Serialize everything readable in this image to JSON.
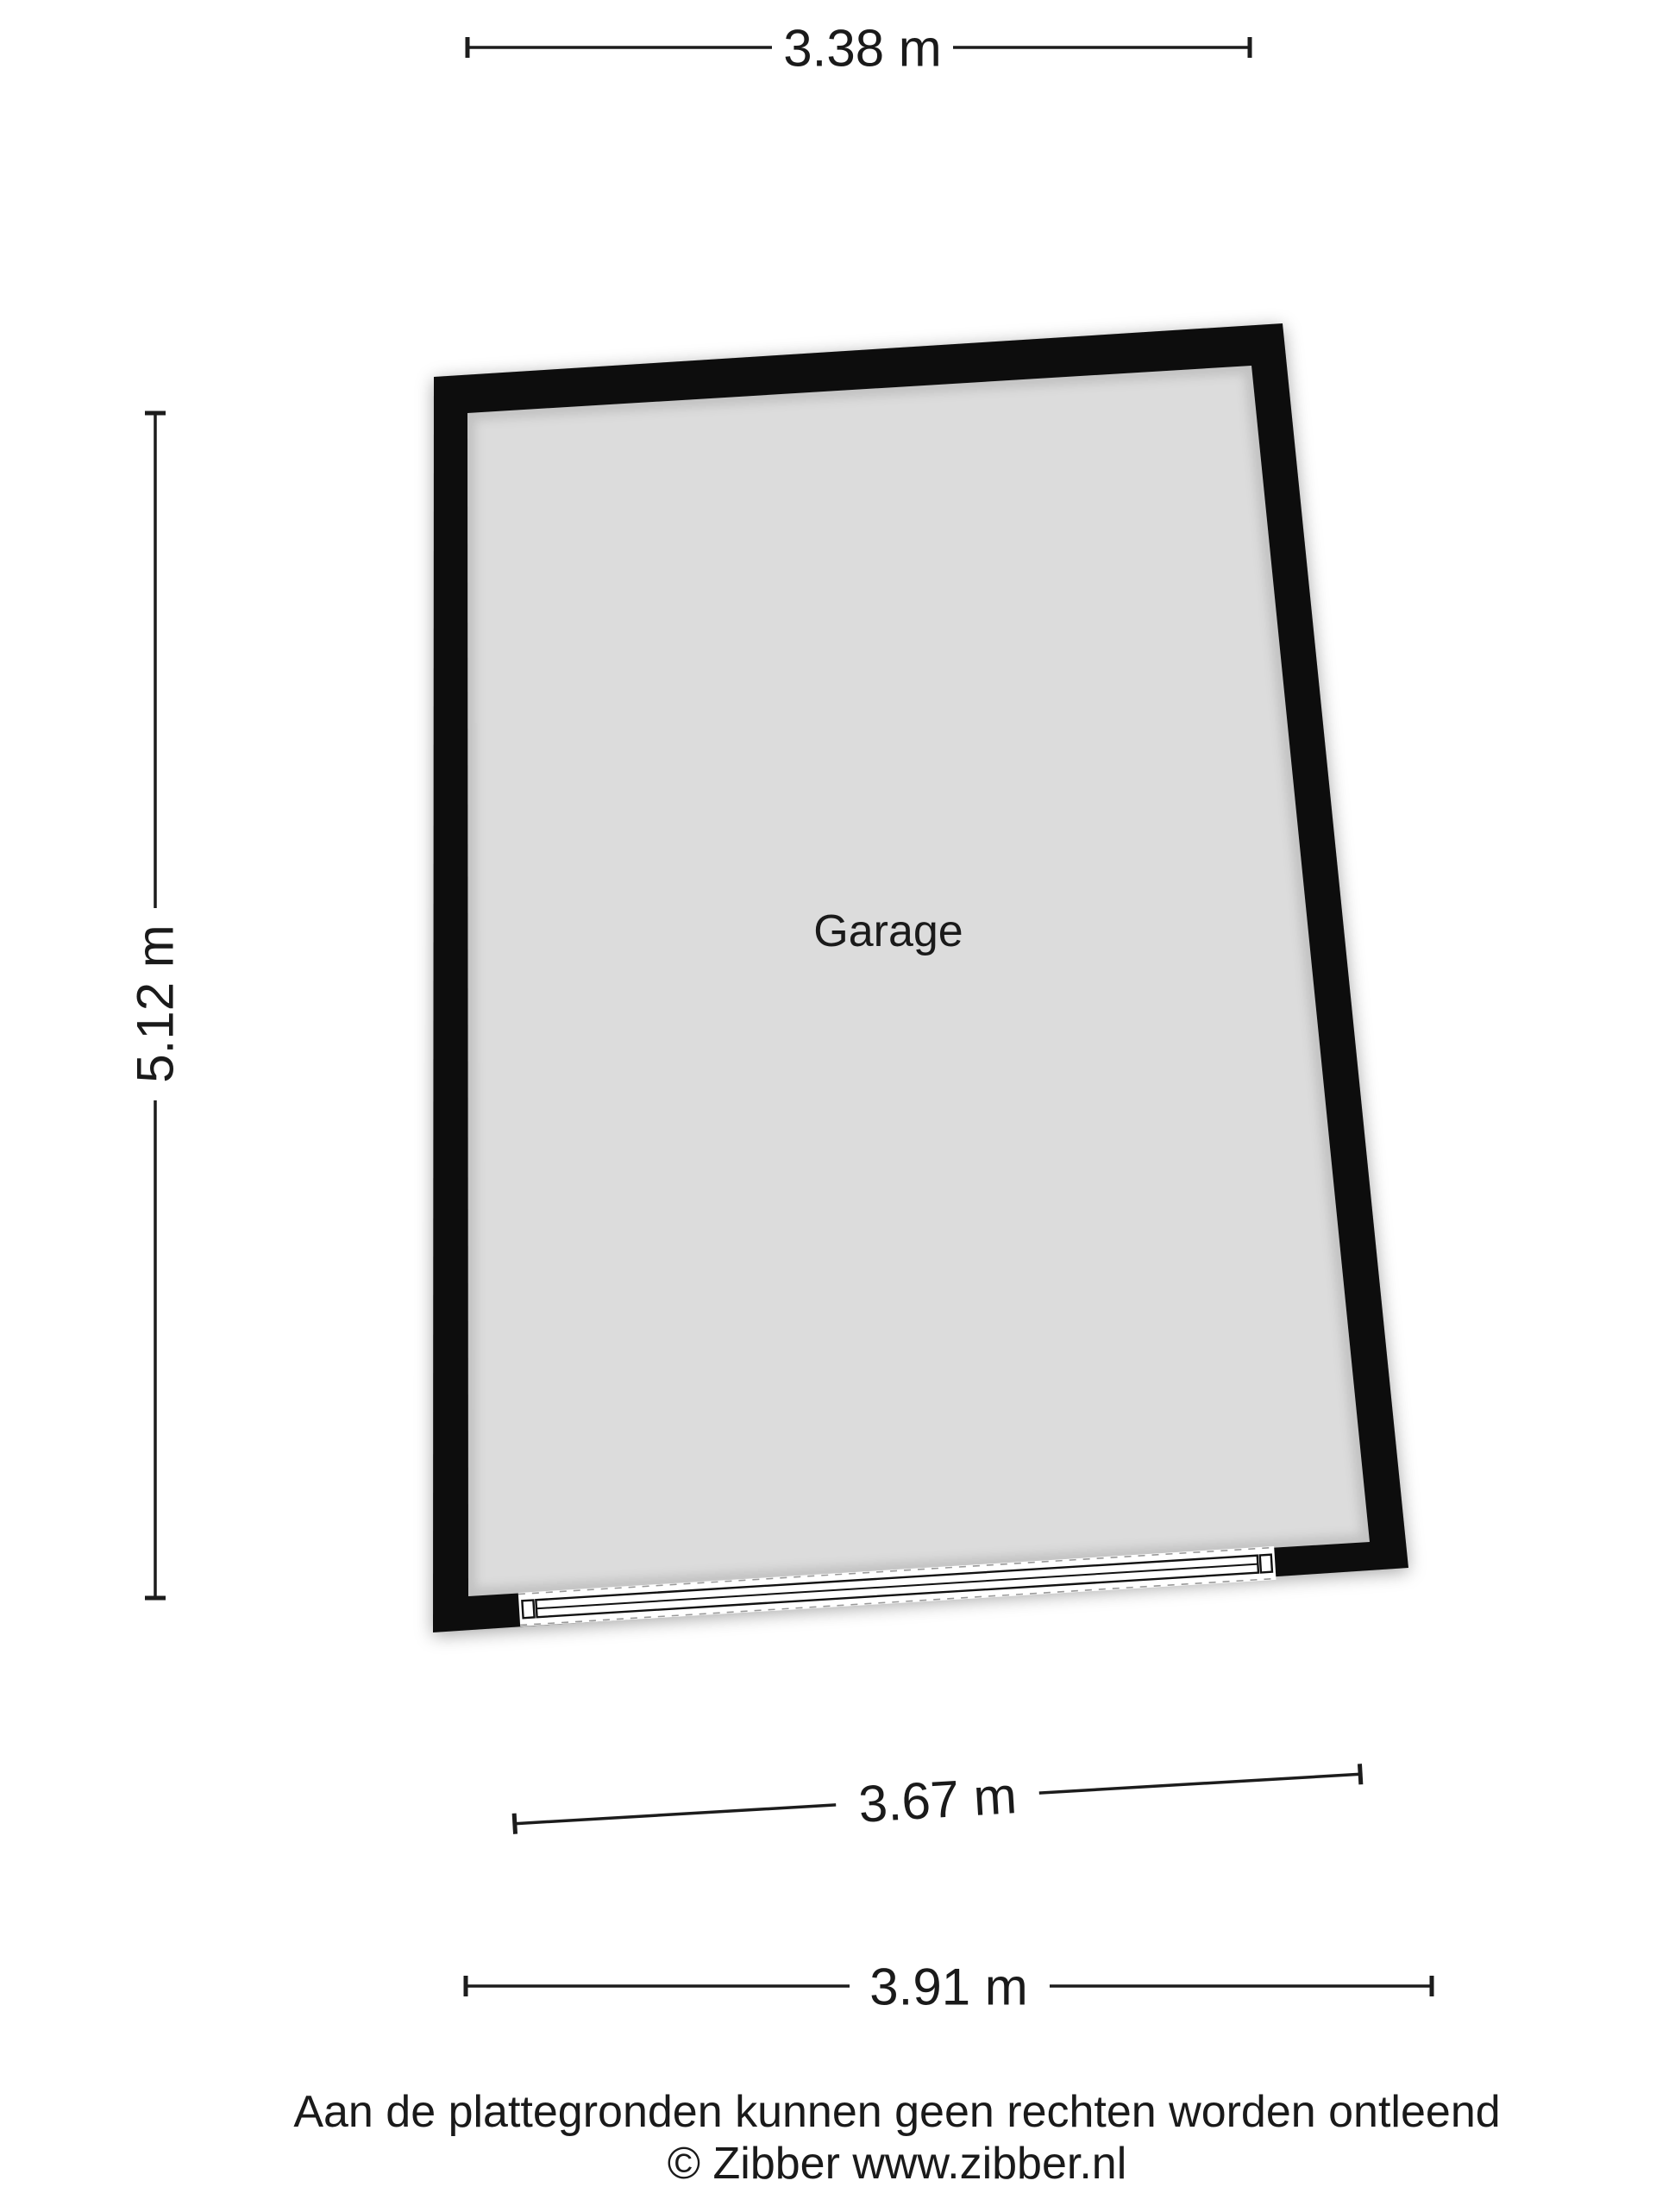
{
  "plan": {
    "room_label": "Garage",
    "colors": {
      "wall": "#0b0b0b",
      "floor": "#dcdcdc",
      "door_fill": "#ffffff",
      "door_line": "#111111",
      "dashed_edge": "#999999",
      "dim_line": "#1c1c1c",
      "text": "#1a1a1a",
      "background": "#ffffff"
    }
  },
  "dimensions": {
    "top_width": "3.38 m",
    "left_height": "5.12 m",
    "inner_bottom_width": "3.67 m",
    "outer_bottom_width": "3.91 m"
  },
  "footer": {
    "disclaimer": "Aan de plattegronden kunnen geen rechten worden ontleend",
    "copyright": "© Zibber www.zibber.nl"
  }
}
